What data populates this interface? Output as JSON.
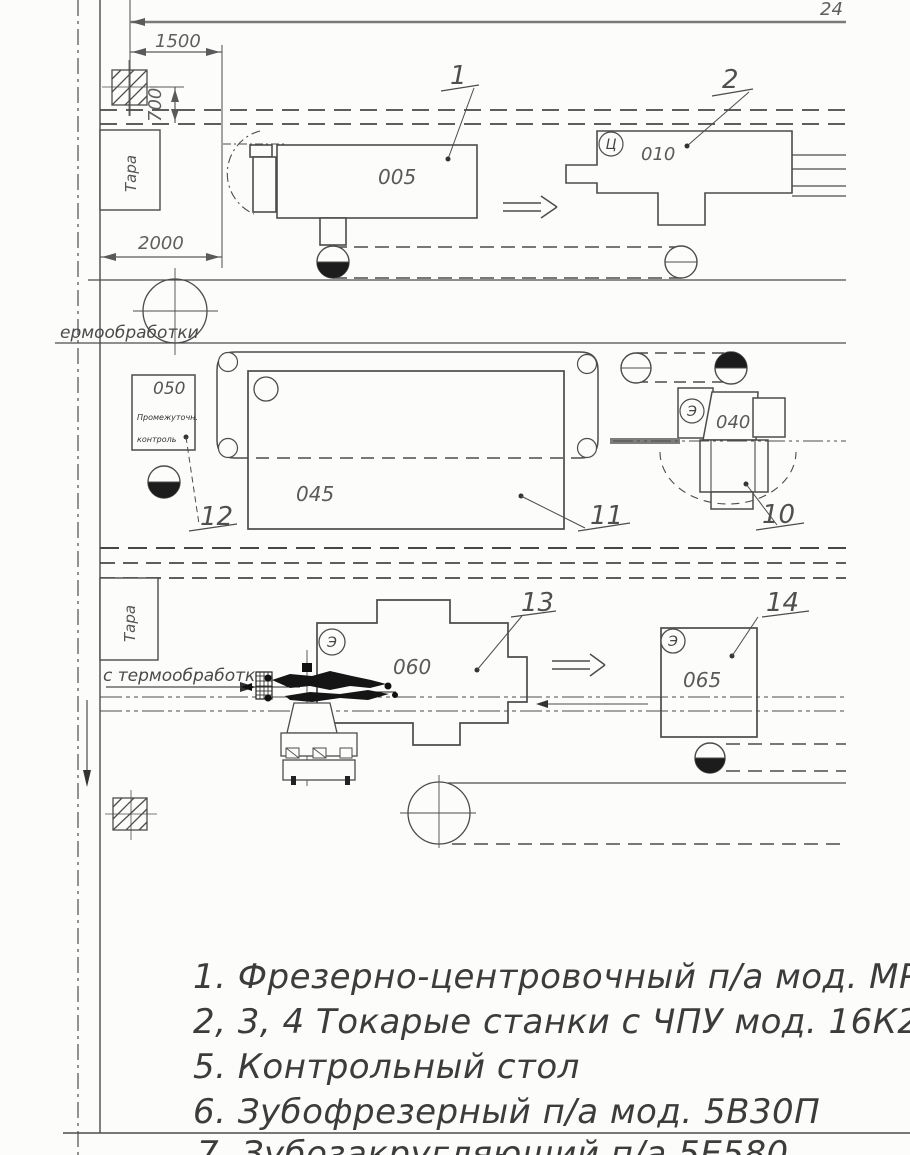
{
  "drawing": {
    "dims": {
      "top": "24",
      "w1500": "1500",
      "h700": "700",
      "w2000": "2000"
    },
    "ops": {
      "op005": "005",
      "op010": "010",
      "op040": "040",
      "op045": "045",
      "op050": "050",
      "op060": "060",
      "op065": "065"
    },
    "tara": "Тара",
    "symbols": {
      "s010": "Ц",
      "s040": "Э",
      "s060": "Э",
      "s065": "Э"
    },
    "callouts": {
      "c1": "1",
      "c2": "2",
      "c10": "10",
      "c11": "11",
      "c12": "12",
      "c13": "13",
      "c14": "14"
    },
    "texts": {
      "to_thermo": "ермообработки",
      "from_thermo": "с термообработки",
      "control_line1": "Промежуточн.",
      "control_line2": "контроль"
    },
    "legend": [
      "1. Фрезерно-центровочный п/а мод. МР-76",
      "2, 3, 4 Токарые станки с ЧПУ мод. 16К20Ф.",
      "5. Контрольный стол",
      "6. Зубофрезерный п/а мод. 5В30П",
      "7. Зубозакругляющий п/а 5Е580"
    ]
  }
}
